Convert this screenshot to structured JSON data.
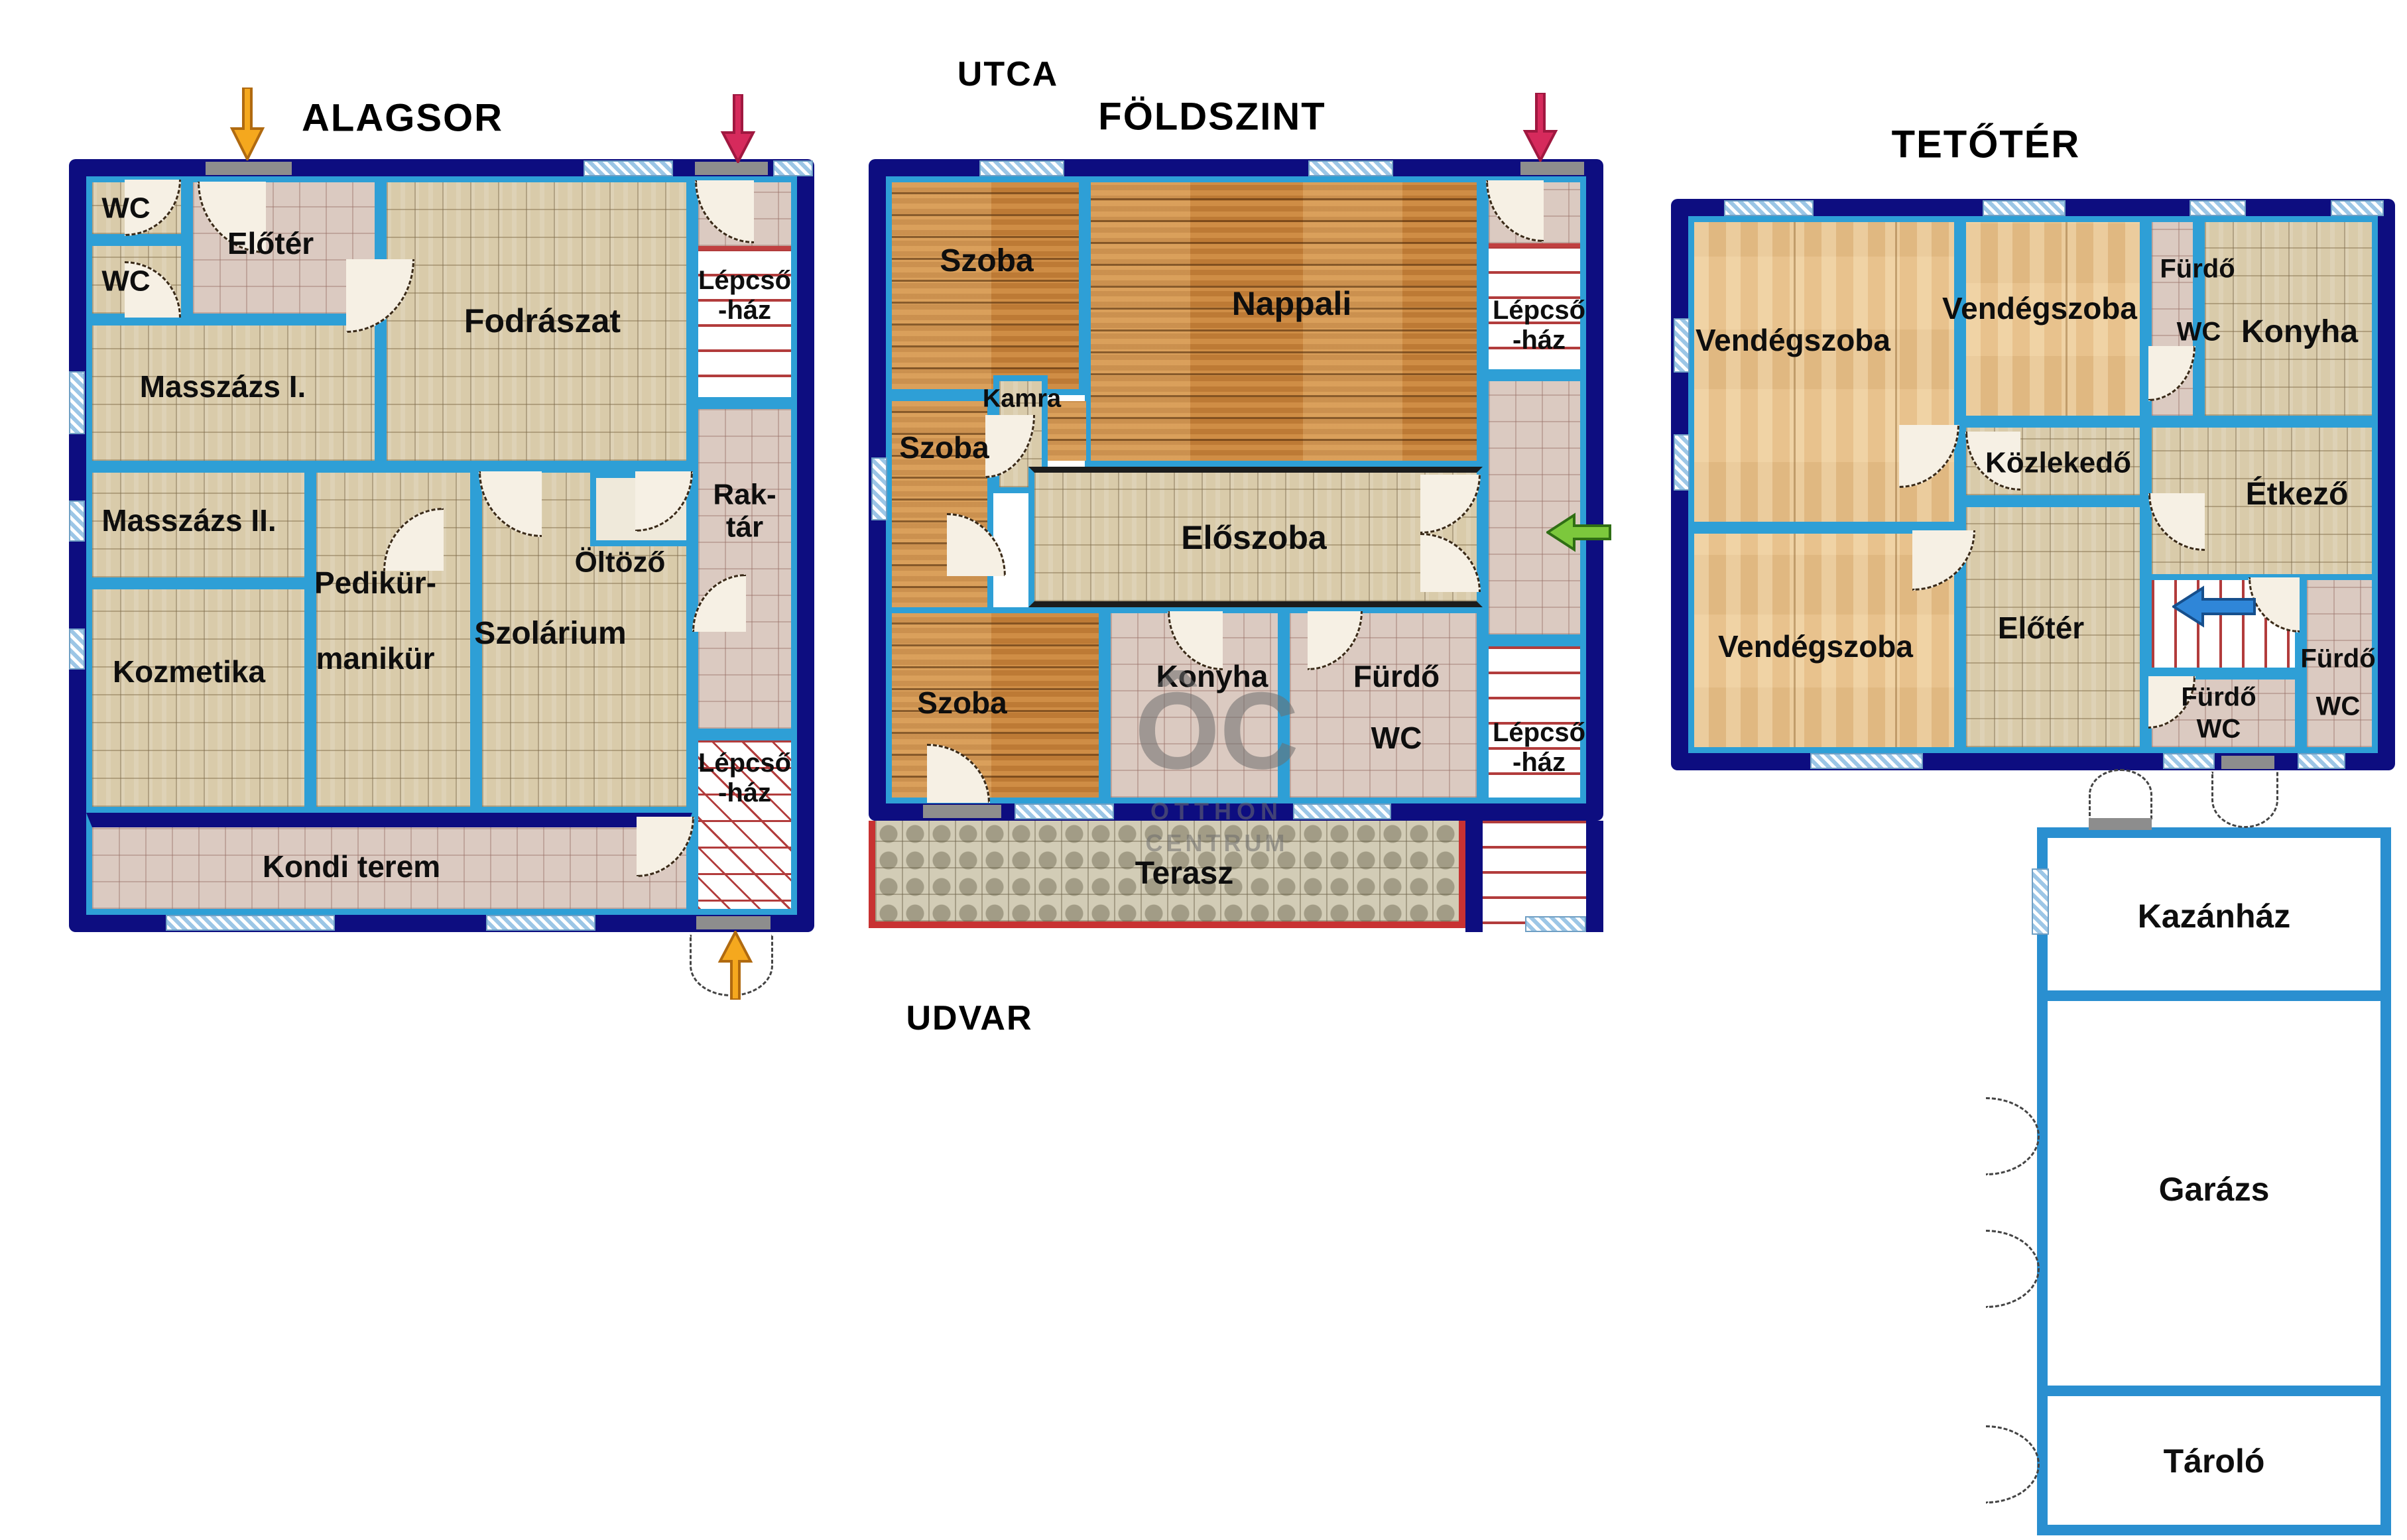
{
  "titles": {
    "basement": "ALAGSOR",
    "ground": "FÖLDSZINT",
    "attic": "TETŐTÉR"
  },
  "outdoor": {
    "street": "UTCA",
    "yard": "UDVAR"
  },
  "watermark": {
    "logo": "ÔC",
    "line1": "OTTHON",
    "line2": "CENTRUM"
  },
  "basement": {
    "wc1": "WC",
    "wc2": "WC",
    "eloter": "Előtér",
    "fodraszat": "Fodrászat",
    "lepcso_top": "Lépcső\n-ház",
    "masszazs1": "Masszázs I.",
    "masszazs2": "Masszázs II.",
    "raktar": "Rak-\ntár",
    "oltozo": "Öltöző",
    "pedikur_line1": "Pedikür-",
    "pedikur_line2": "manikür",
    "szolarium": "Szolárium",
    "kozmetika": "Kozmetika",
    "kondi": "Kondi terem",
    "lepcso_bottom": "Lépcső\n-ház"
  },
  "ground": {
    "szoba1": "Szoba",
    "nappali": "Nappali",
    "lepcso_top": "Lépcső\n-ház",
    "kamra": "Kamra",
    "szoba2": "Szoba",
    "eloszoba": "Előszoba",
    "szoba3": "Szoba",
    "konyha": "Konyha",
    "furdo": "Fürdő",
    "furdo_wc": "WC",
    "lepcso_bottom": "Lépcső\n-ház",
    "terasz": "Terasz"
  },
  "attic": {
    "vendegszoba1": "Vendégszoba",
    "vendegszoba2": "Vendégszoba",
    "furdo1": "Fürdő",
    "wc1": "WC",
    "konyha": "Konyha",
    "kozlekedo": "Közlekedő",
    "etkezo": "Étkező",
    "vendegszoba3": "Vendégszoba",
    "eloter": "Előtér",
    "furdo2": "Fürdő",
    "wc2": "WC",
    "furdo3": "Fürdő",
    "wc3": "WC"
  },
  "outbuilding": {
    "kazanhaz": "Kazánház",
    "garazs": "Garázs",
    "tarolo": "Tároló"
  },
  "icons": {
    "basement_street_entry": "arrow-down-orange",
    "basement_yard_entry": "arrow-up-orange",
    "basement_stair_entry": "arrow-down-red",
    "ground_stair_entry": "arrow-down-red",
    "ground_main_entry": "arrow-left-green",
    "attic_stair": "arrow-left-blue"
  },
  "colors": {
    "outer_wall": "#0d0d80",
    "partition": "#2e9fd6",
    "outbuilding_wall": "#2a8fd0",
    "tile_beige": "#d9cbaa",
    "tile_pink": "#dbcac1",
    "wood_dark": "#bd7a35",
    "wood_light": "#e8c28d",
    "stair_red": "#b23c3c",
    "terrace_border": "#c83232",
    "window_blue": "#9cc6e6",
    "arrow_orange": "#f5a81e",
    "arrow_red": "#d62a5c",
    "arrow_green": "#7cc83c",
    "arrow_blue": "#2f86d8",
    "watermark_gray": "#6e6e6e"
  }
}
